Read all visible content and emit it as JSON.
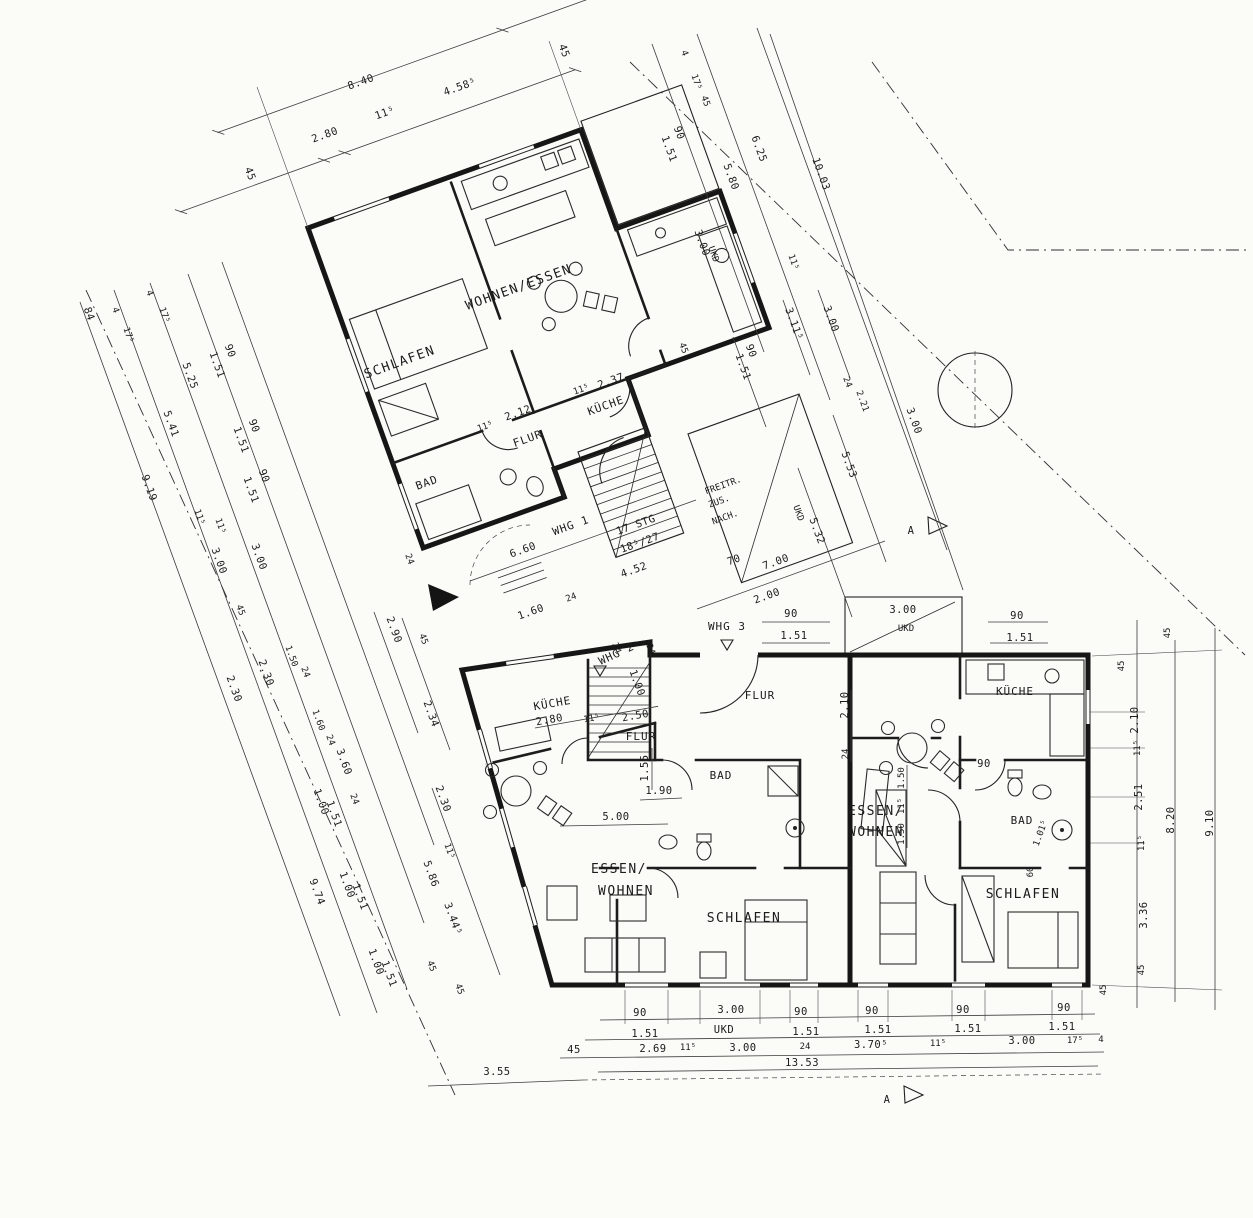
{
  "apartments": {
    "whg1": {
      "label": "WHG 1",
      "wohnen": "WOHNEN/ESSEN",
      "schlafen": "SCHLAFEN",
      "kueche": "KÜCHE",
      "flur": "FLUR",
      "bad": "BAD"
    },
    "whg2": {
      "label": "WHG 2",
      "kueche": "KÜCHE",
      "flur": "FLUR",
      "bad": "BAD",
      "essen1": "ESSEN/",
      "essen2": "WOHNEN",
      "schlafen": "SCHLAFEN"
    },
    "whg3": {
      "label": "WHG 3",
      "kueche": "KÜCHE",
      "flur": "FLUR",
      "bad": "BAD",
      "essen1": "ESSEN/",
      "essen2": "WOHNEN",
      "schlafen": "SCHLAFEN"
    }
  },
  "stairs": {
    "note1": "17 STG",
    "note2": "18⁵/27",
    "out1": "FREITR.",
    "out2": "ZUS.",
    "out3": "NACH.",
    "width": "70",
    "run": "2.00",
    "total": "7.00"
  },
  "markers": {
    "section": "A"
  },
  "dims": {
    "top": [
      "45",
      "2.80",
      "11⁵",
      "8.40",
      "4.58⁵",
      "45"
    ],
    "top_right": [
      "4",
      "17⁵",
      "45",
      "90",
      "1.51",
      "5.80",
      "6.25",
      "10.03",
      "3.00",
      "UKD",
      "11⁵"
    ],
    "mid": [
      "90",
      "1.51",
      "3.11⁵",
      "3.00",
      "24",
      "2.21",
      "3.00",
      "5.53",
      "5.32",
      "UKD"
    ],
    "upper_in": [
      "2.37",
      "11⁵",
      "45",
      "2.12",
      "11⁵",
      "6.60",
      "4.52",
      "1.60",
      "24",
      "2.90",
      "24"
    ],
    "left": [
      "84",
      "9.19",
      "4",
      "17⁵",
      "5.41",
      "4",
      "17⁵",
      "5.25",
      "90",
      "1.51",
      "90",
      "1.51",
      "90",
      "1.51",
      "11⁵",
      "3.00",
      "3.00",
      "45",
      "2.30",
      "2.30",
      "1.50",
      "24",
      "1.60",
      "24",
      "3.60",
      "11⁵",
      "24",
      "1.00",
      "1.51",
      "1.00",
      "1.51",
      "1.00",
      "1.51",
      "9.74"
    ],
    "left_in": [
      "45",
      "2.34",
      "2.30",
      "11⁵",
      "5.86",
      "3.44⁵",
      "45",
      "45",
      "24"
    ],
    "right": [
      "45",
      "45",
      "2.10",
      "11⁵",
      "2.51",
      "11⁵",
      "3.36",
      "45",
      "45",
      "8.20",
      "9.10"
    ],
    "bottom_a": [
      "90",
      "3.00",
      "90",
      "90",
      "90",
      "90"
    ],
    "bottom_b": [
      "1.51",
      "UKD",
      "1.51",
      "1.51",
      "1.51",
      "1.51"
    ],
    "bottom_c": [
      "45",
      "2.69",
      "11⁵",
      "3.00",
      "24",
      "3.70⁵",
      "11⁵",
      "3.00",
      "17⁵",
      "4"
    ],
    "bottom_total": "13.53",
    "bottom_left": "3.55",
    "whg2_in": [
      "2.80",
      "11⁵",
      "2.50",
      "1.55",
      "1.90",
      "5.00",
      "1.00",
      "24"
    ],
    "whg3_in": [
      "90",
      "1.51",
      "3.00",
      "UKD",
      "2.10",
      "24",
      "1.50",
      "11⁵",
      "1.50",
      "90",
      "60",
      "1.01⁵",
      "90",
      "1.51"
    ]
  }
}
